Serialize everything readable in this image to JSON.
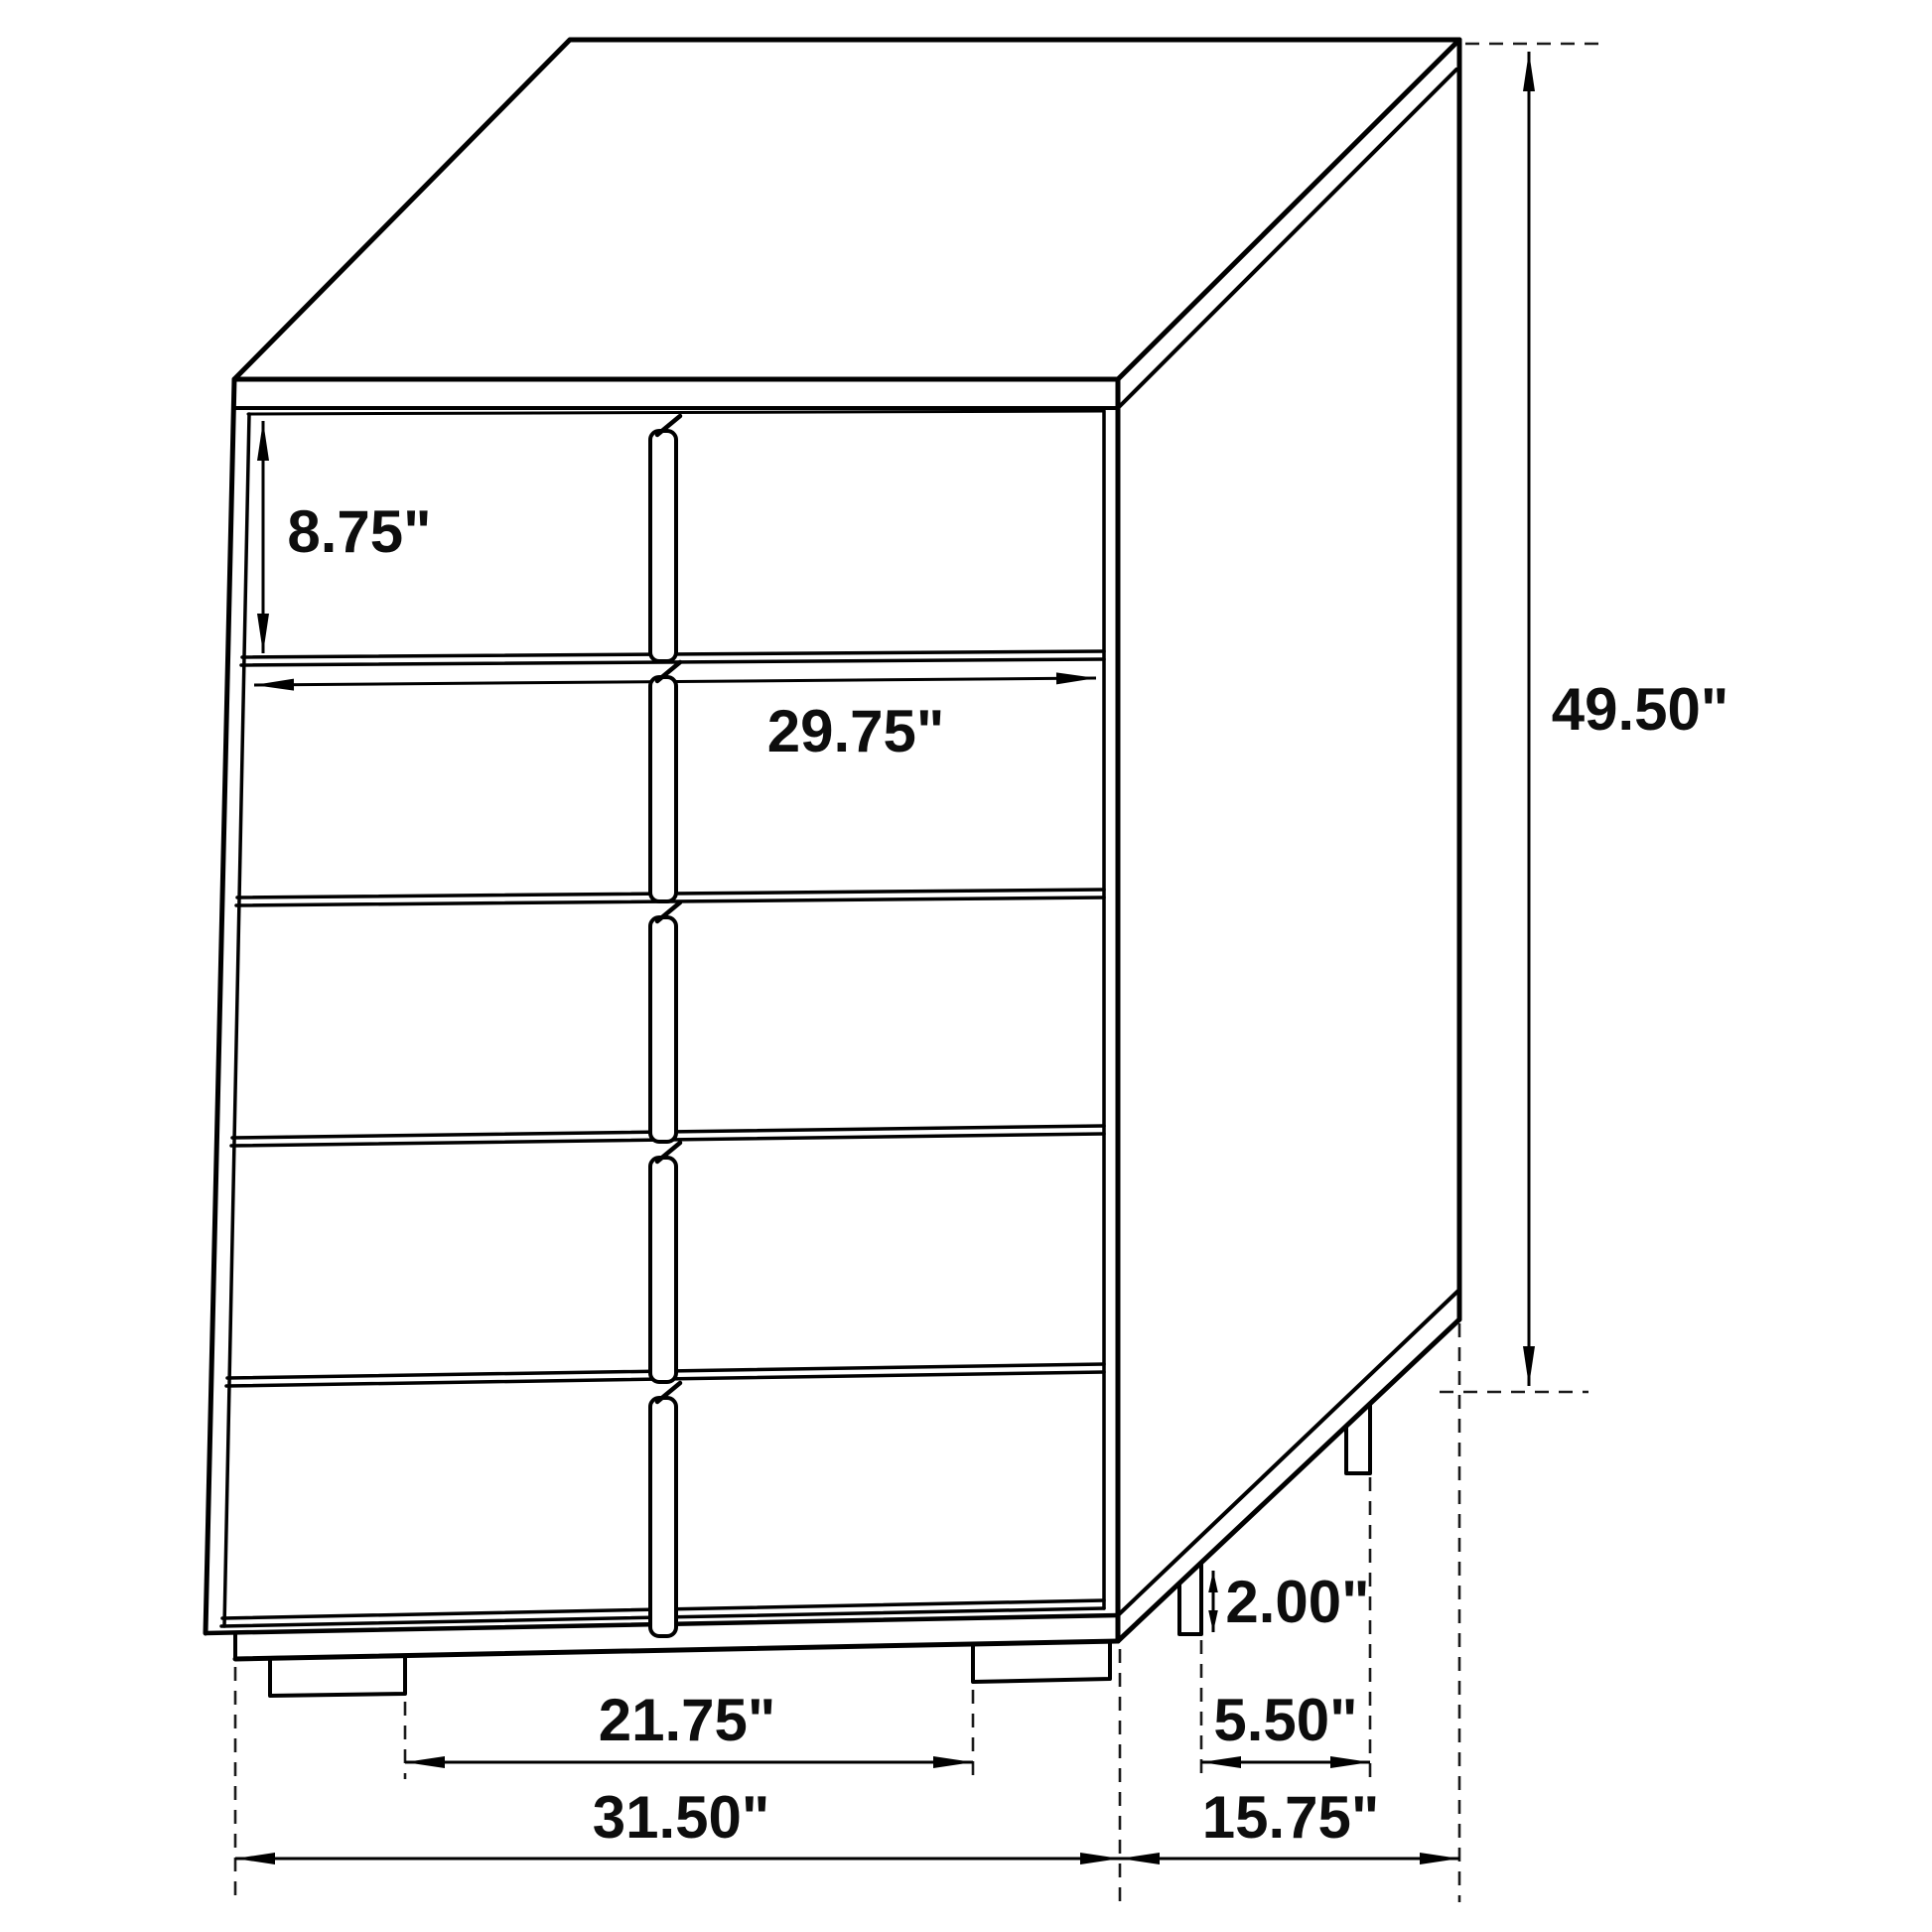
{
  "page": {
    "background": "#ffffff",
    "line_color": "#000000",
    "text_color": "#0d0d0d"
  },
  "drawing": {
    "subject": "five-drawer chest dimension diagram",
    "view": "three-quarter perspective line drawing",
    "drawer_count": 5,
    "dimensions": {
      "top_drawer_height": "8.75\"",
      "drawer_width": "29.75\"",
      "overall_height": "49.50\"",
      "foot_height": "2.00\"",
      "side_foot_spacing": "5.50\"",
      "front_foot_spacing": "21.75\"",
      "overall_width": "31.50\"",
      "overall_depth": "15.75\""
    }
  }
}
